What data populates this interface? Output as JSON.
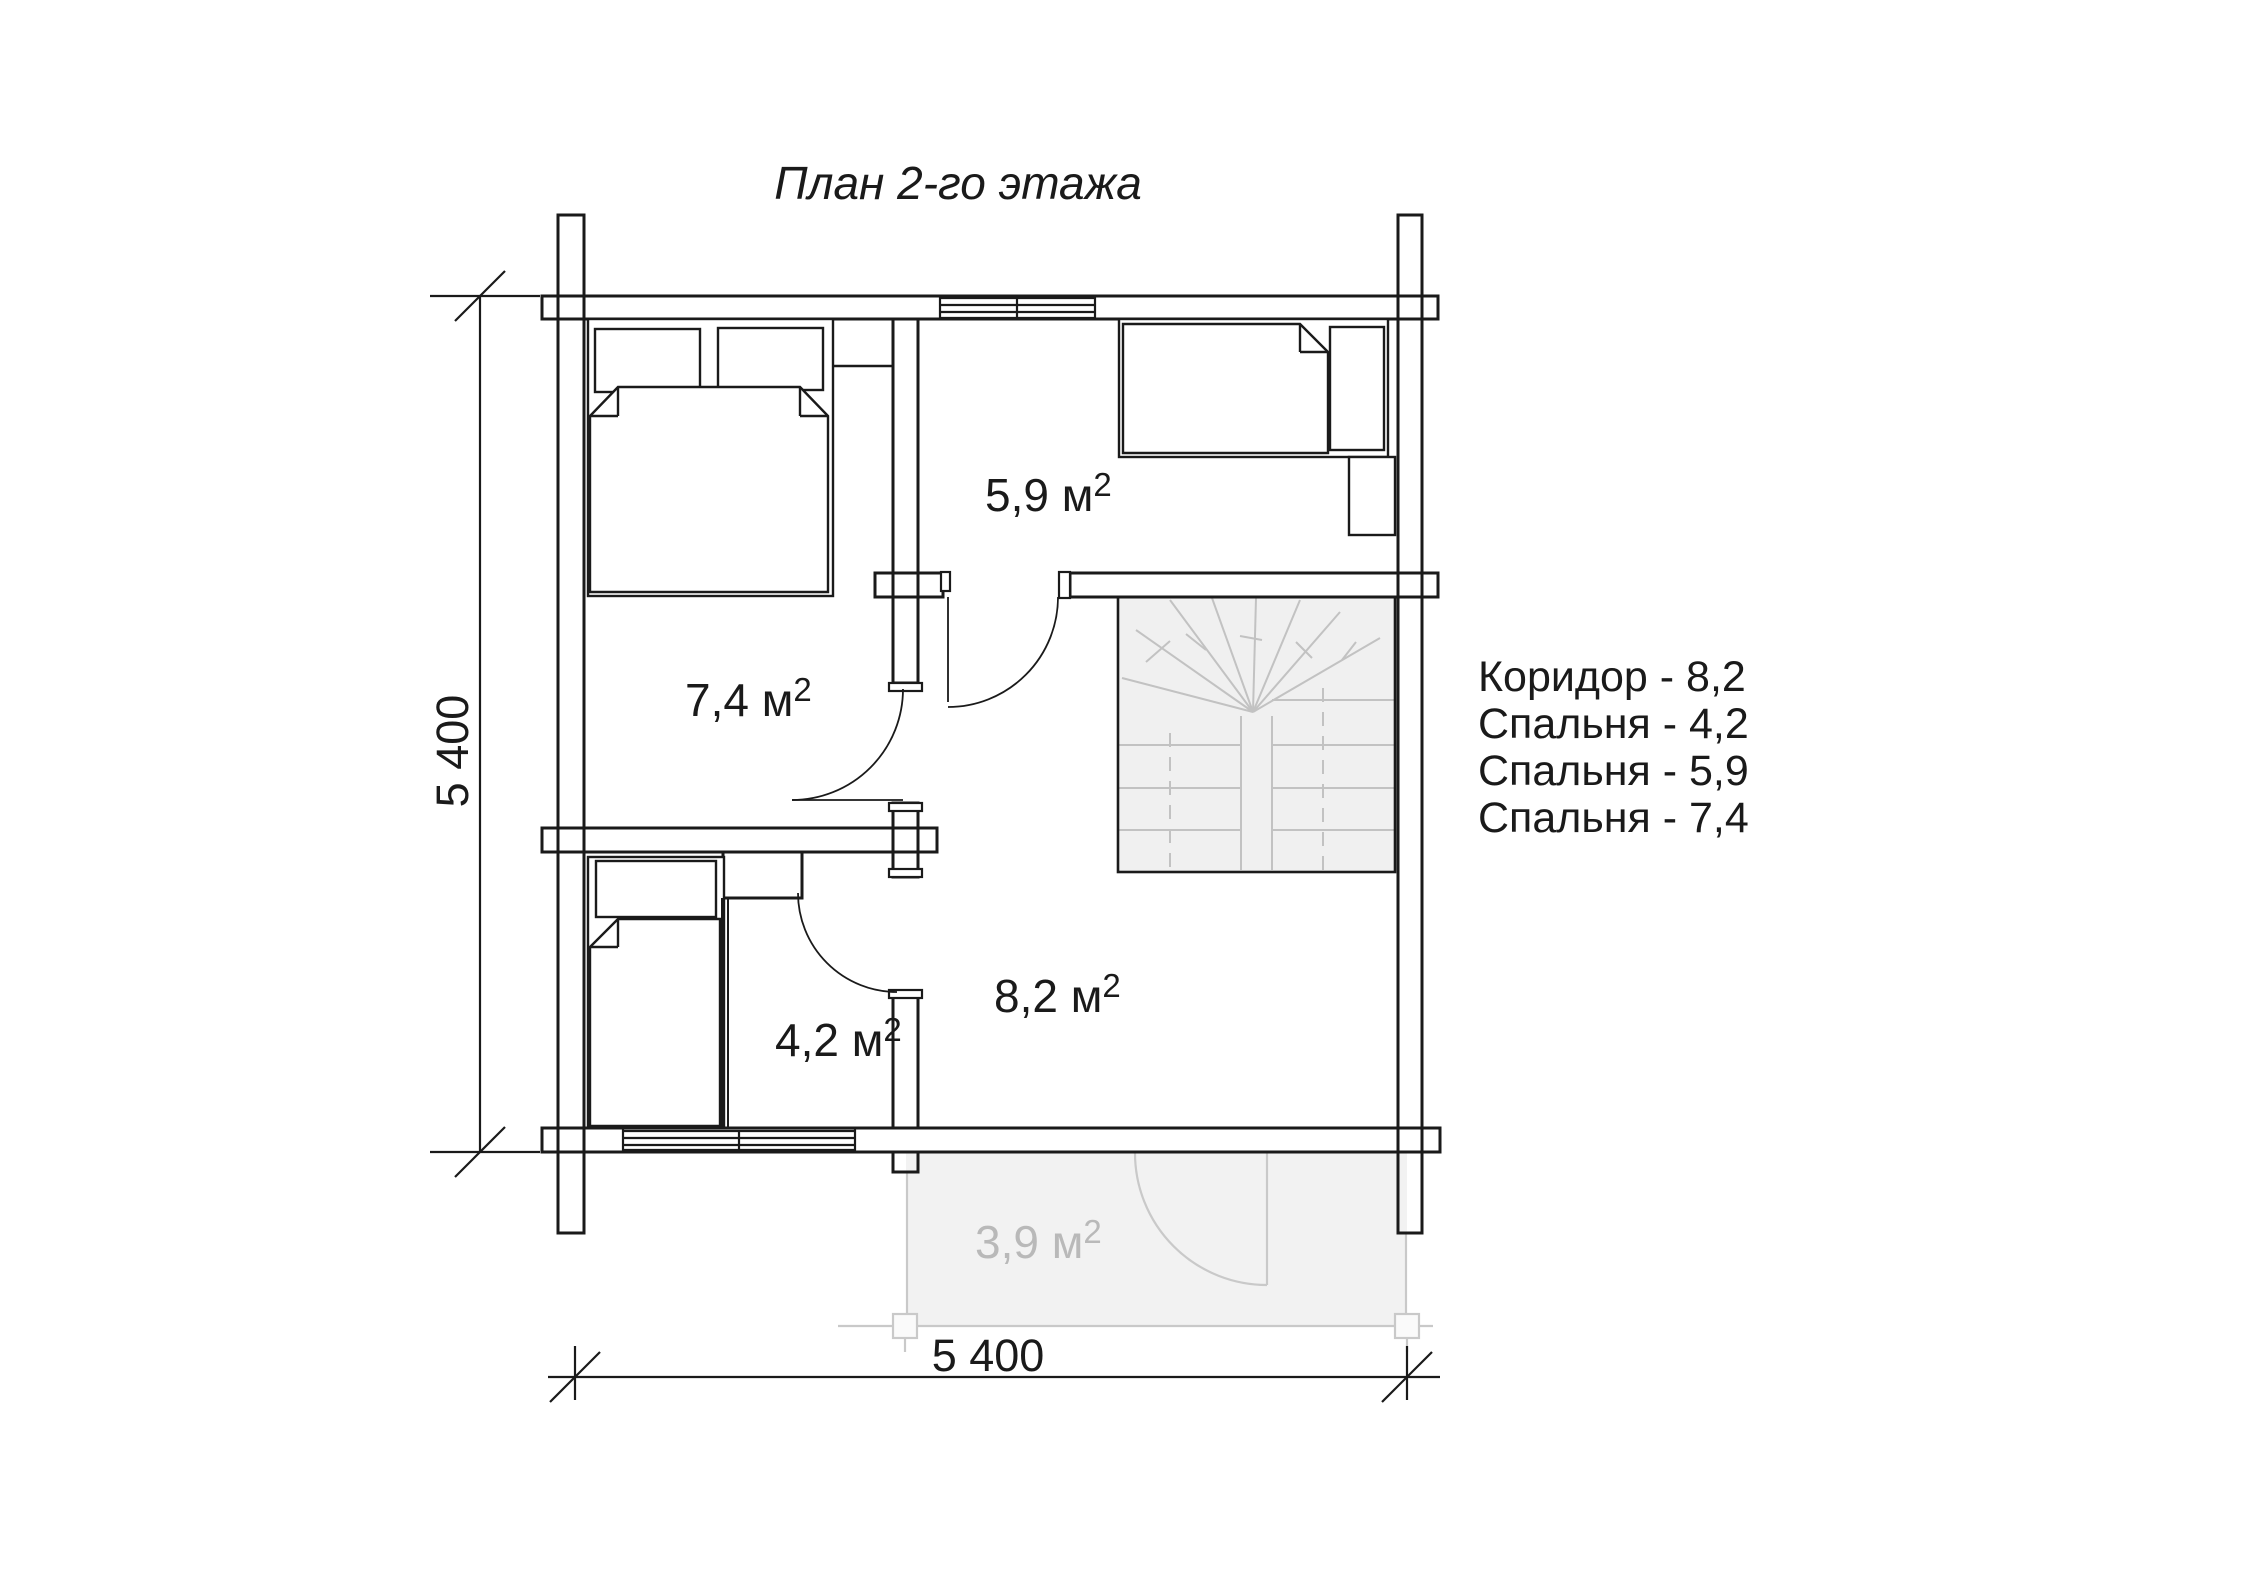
{
  "title": "План 2-го этажа",
  "floor_plan": {
    "rooms": [
      {
        "id": "bedroom-59",
        "label": "5,9 м",
        "sup": "2",
        "area_m2": 5.9,
        "type": "bedroom"
      },
      {
        "id": "bedroom-74",
        "label": "7,4 м",
        "sup": "2",
        "area_m2": 7.4,
        "type": "bedroom"
      },
      {
        "id": "corridor-82",
        "label": "8,2 м",
        "sup": "2",
        "area_m2": 8.2,
        "type": "corridor"
      },
      {
        "id": "bedroom-42",
        "label": "4,2 м",
        "sup": "2",
        "area_m2": 4.2,
        "type": "bedroom"
      },
      {
        "id": "balcony-39",
        "label": "3,9 м",
        "sup": "2",
        "area_m2": 3.9,
        "type": "balcony"
      }
    ],
    "features": [
      "double-bed",
      "single-bed",
      "single-bed",
      "winder-staircase",
      "balcony-door",
      "windows"
    ]
  },
  "legend": {
    "items": [
      {
        "text": "Коридор - 8,2"
      },
      {
        "text": "Спальня - 4,2"
      },
      {
        "text": "Спальня - 5,9"
      },
      {
        "text": "Спальня - 7,4"
      }
    ]
  },
  "dimensions": {
    "left": "5 400",
    "bottom": "5 400"
  },
  "colors": {
    "line": "#1a1a1a",
    "light_line": "#c2c2c2",
    "stair_fill": "#f0f0f0",
    "balcony_fill": "#f2f2f2",
    "gray_text": "#b9b9b9",
    "background": "#ffffff"
  }
}
